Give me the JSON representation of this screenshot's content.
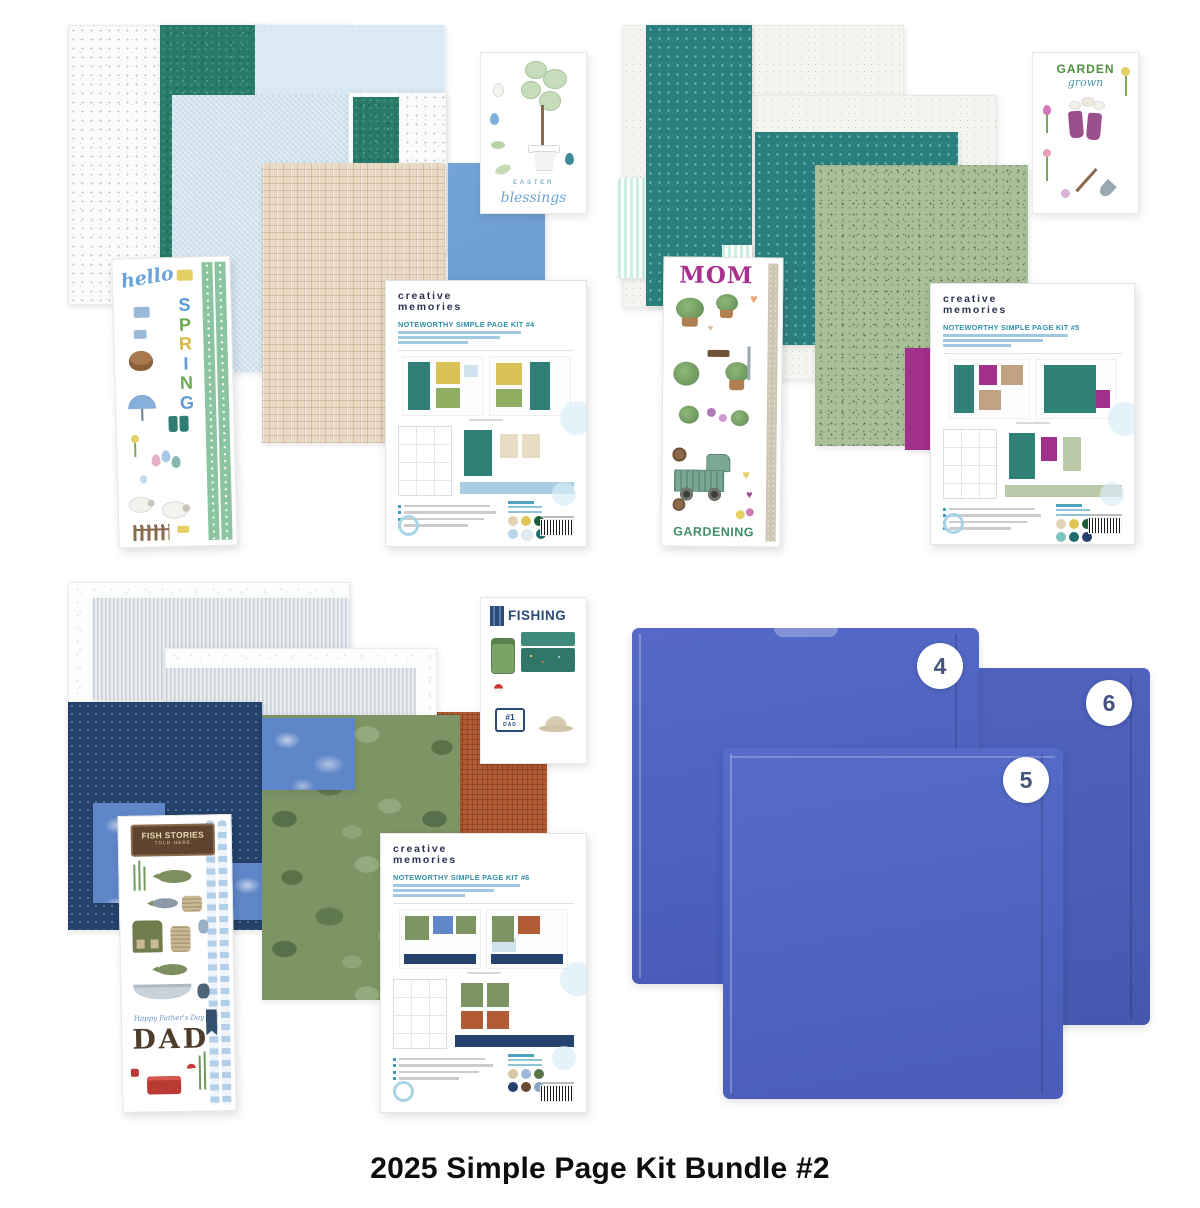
{
  "title": "2025 Simple Page Kit Bundle #2",
  "brand": {
    "line1": "creative",
    "line2": "memories"
  },
  "kits": {
    "kit4": {
      "name": "NOTEWORTHY SIMPLE PAGE KIT #4"
    },
    "kit5": {
      "name": "NOTEWORTHY SIMPLE PAGE KIT #5"
    },
    "kit6": {
      "name": "NOTEWORTHY SIMPLE PAGE KIT #6"
    }
  },
  "stickers": {
    "spring": {
      "hello": "hello",
      "letters": [
        "S",
        "P",
        "R",
        "I",
        "N",
        "G"
      ]
    },
    "easter": {
      "word": "EASTER",
      "script": "blessings"
    },
    "garden": {
      "word": "GARDEN",
      "script": "grown"
    },
    "mom": {
      "top": "MOM",
      "bottom": "GARDENING"
    },
    "dad": {
      "sign_line1": "FISH STORIES",
      "sign_line2": "TOLD HERE",
      "script": "Happy Father's Day",
      "word": "DAD"
    },
    "fishing": {
      "word": "FISHING",
      "plate_top": "#1",
      "plate_bottom": "DAD"
    }
  },
  "protectors": {
    "pack4": "4",
    "pack5": "5",
    "pack6": "6"
  },
  "colors": {
    "teal": "#2a7f7d",
    "navy": "#24426b",
    "magenta": "#a1308c",
    "protector_blue": "#4d64bf",
    "camo_green": "#7e9465",
    "rust": "#b25c35",
    "brand_navy": "#2a3350",
    "kit_title_teal": "#2f8fa7"
  }
}
